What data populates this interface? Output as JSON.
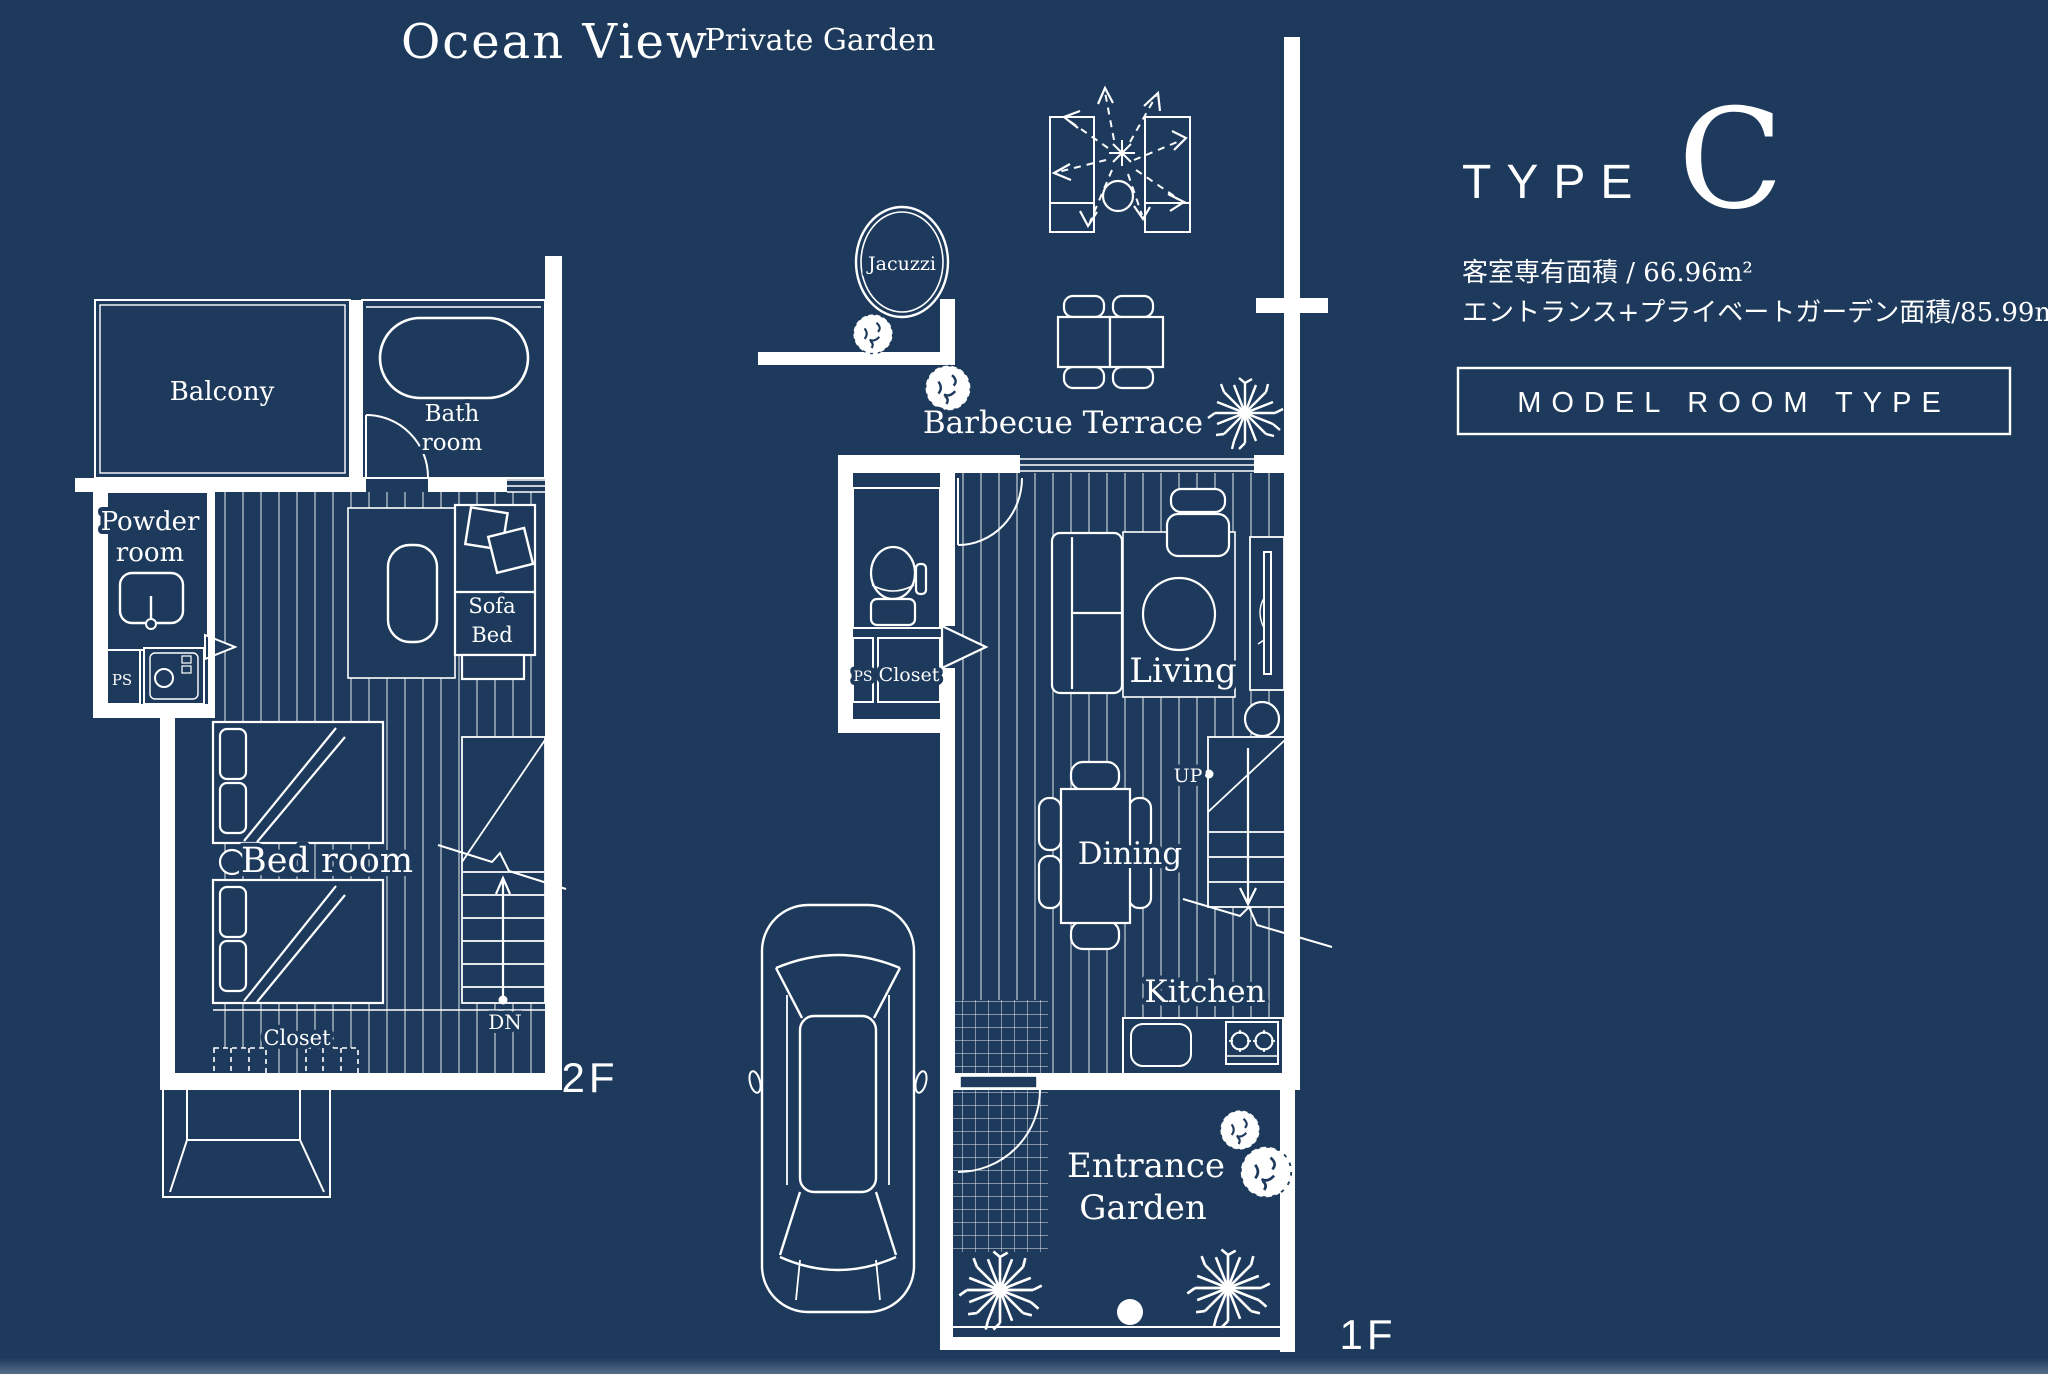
{
  "palette": {
    "background": "#1d3a5c",
    "line": "#ffffff"
  },
  "titles": {
    "ocean_view": "Ocean View",
    "private_garden": "Private Garden"
  },
  "info_panel": {
    "type_word": "TYPE",
    "type_letter": "C",
    "area_line1": "客室専有面積 / 66.96m²",
    "area_line2": "エントランス+プライベートガーデン面積/85.99m²",
    "model_room_label": "MODEL ROOM TYPE"
  },
  "floor_2f": {
    "tag": "2F",
    "labels": {
      "balcony": "Balcony",
      "bath_line1": "Bath",
      "bath_line2": "room",
      "powder_line1": "Powder",
      "powder_line2": "room",
      "ps": "PS",
      "sofa_line1": "Sofa",
      "sofa_line2": "Bed",
      "bedroom": "Bed room",
      "closet": "Closet",
      "dn": "DN"
    }
  },
  "floor_1f": {
    "tag": "1F",
    "labels": {
      "jacuzzi": "Jacuzzi",
      "barbecue_terrace": "Barbecue Terrace",
      "ps": "PS",
      "closet": "Closet",
      "living": "Living",
      "up": "UP",
      "dining": "Dining",
      "kitchen": "Kitchen",
      "entrance_line1": "Entrance",
      "entrance_line2": "Garden"
    }
  }
}
